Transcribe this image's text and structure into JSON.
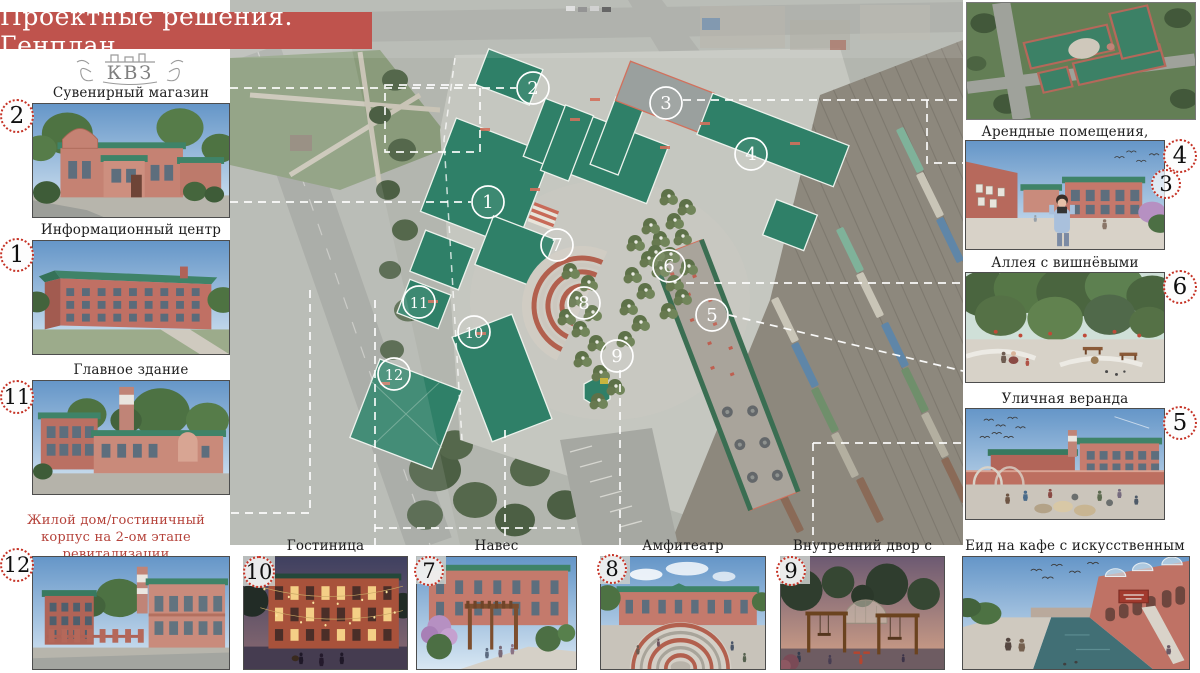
{
  "title": "Проектные решения. Генплан",
  "logo": {
    "text": "КВЗ"
  },
  "left_items": [
    {
      "num": "2",
      "label": "Сувенирный магазин",
      "scene": "shop-day"
    },
    {
      "num": "1",
      "label": "Информационный центр",
      "scene": "info-center-day"
    },
    {
      "num": "11",
      "label": "Главное здание",
      "scene": "main-building-day"
    },
    {
      "num": "12",
      "label": "Жилой дом/гостиничный корпус на 2-ом этапе ревитализации",
      "scene": "housing-day"
    }
  ],
  "right_aerial": {
    "scene": "aerial-complex"
  },
  "right_items": [
    {
      "label": "Арендные помещения, мастерские",
      "scene": "rental-yard",
      "nums": [
        "4",
        "3"
      ]
    },
    {
      "label": "Аллея с вишнёвыми деревьями",
      "scene": "cherry-alley",
      "nums": [
        "6"
      ]
    },
    {
      "label": "Уличная веранда",
      "scene": "street-veranda",
      "nums": [
        "5"
      ]
    }
  ],
  "bottom_items": [
    {
      "num": "10",
      "label": "Гостиница",
      "scene": "hotel-night"
    },
    {
      "num": "7",
      "label": "Навес",
      "scene": "canopy"
    },
    {
      "num": "8",
      "label": "Амфитеатр",
      "scene": "amphitheater"
    },
    {
      "num": "9",
      "label": "Внутренний двор с качелями",
      "scene": "swing-courtyard"
    },
    {
      "num": "",
      "label": "Еид на кафе с искусственным прудом",
      "scene": "cafe-pond"
    }
  ],
  "map": {
    "circles": [
      {
        "num": "1",
        "x": 258,
        "y": 202
      },
      {
        "num": "2",
        "x": 303,
        "y": 88
      },
      {
        "num": "3",
        "x": 436,
        "y": 103
      },
      {
        "num": "4",
        "x": 521,
        "y": 154
      },
      {
        "num": "5",
        "x": 482,
        "y": 315
      },
      {
        "num": "6",
        "x": 439,
        "y": 266
      },
      {
        "num": "7",
        "x": 327,
        "y": 245
      },
      {
        "num": "8",
        "x": 354,
        "y": 303
      },
      {
        "num": "9",
        "x": 387,
        "y": 356
      },
      {
        "num": "10",
        "x": 244,
        "y": 332
      },
      {
        "num": "11",
        "x": 189,
        "y": 302
      },
      {
        "num": "12",
        "x": 164,
        "y": 374
      }
    ]
  },
  "colors": {
    "banner": "#bf534d",
    "dotted_circle": "#c63326",
    "red_label": "#b5423a",
    "roof_green": "#2f8068"
  }
}
